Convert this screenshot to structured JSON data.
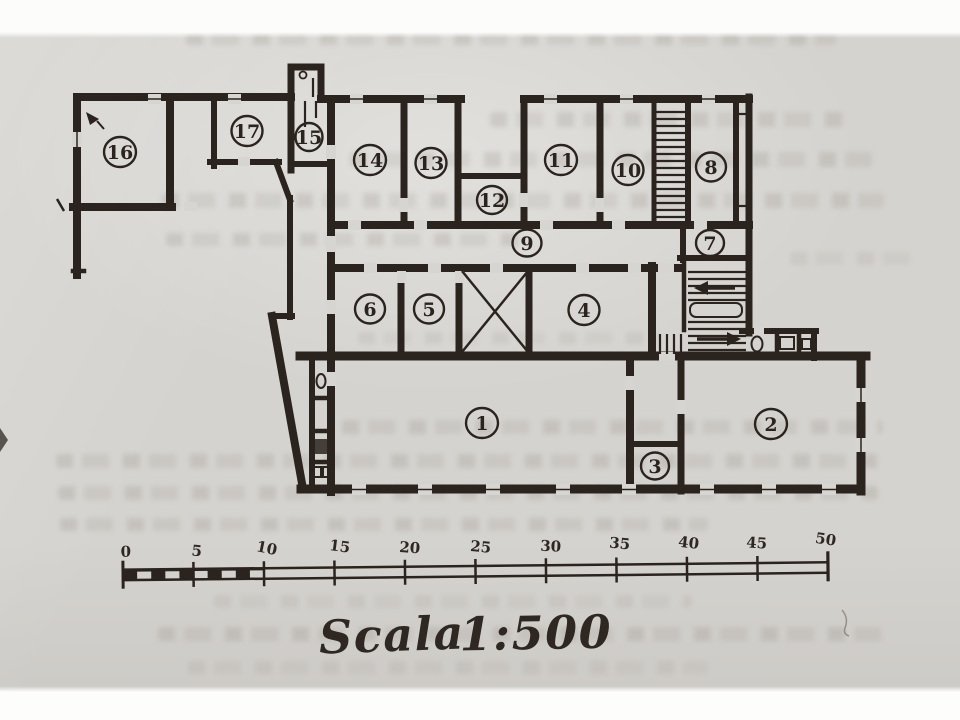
{
  "caption": {
    "word": "Scala",
    "ratio": "1:500"
  },
  "scale_bar": {
    "tick_labels": [
      "0",
      "5",
      "10",
      "15",
      "20",
      "25",
      "30",
      "35",
      "40",
      "45",
      "50"
    ]
  },
  "room_labels": [
    "1",
    "2",
    "3",
    "4",
    "5",
    "6",
    "7",
    "8",
    "9",
    "10",
    "11",
    "12",
    "13",
    "14",
    "15",
    "16",
    "17"
  ]
}
